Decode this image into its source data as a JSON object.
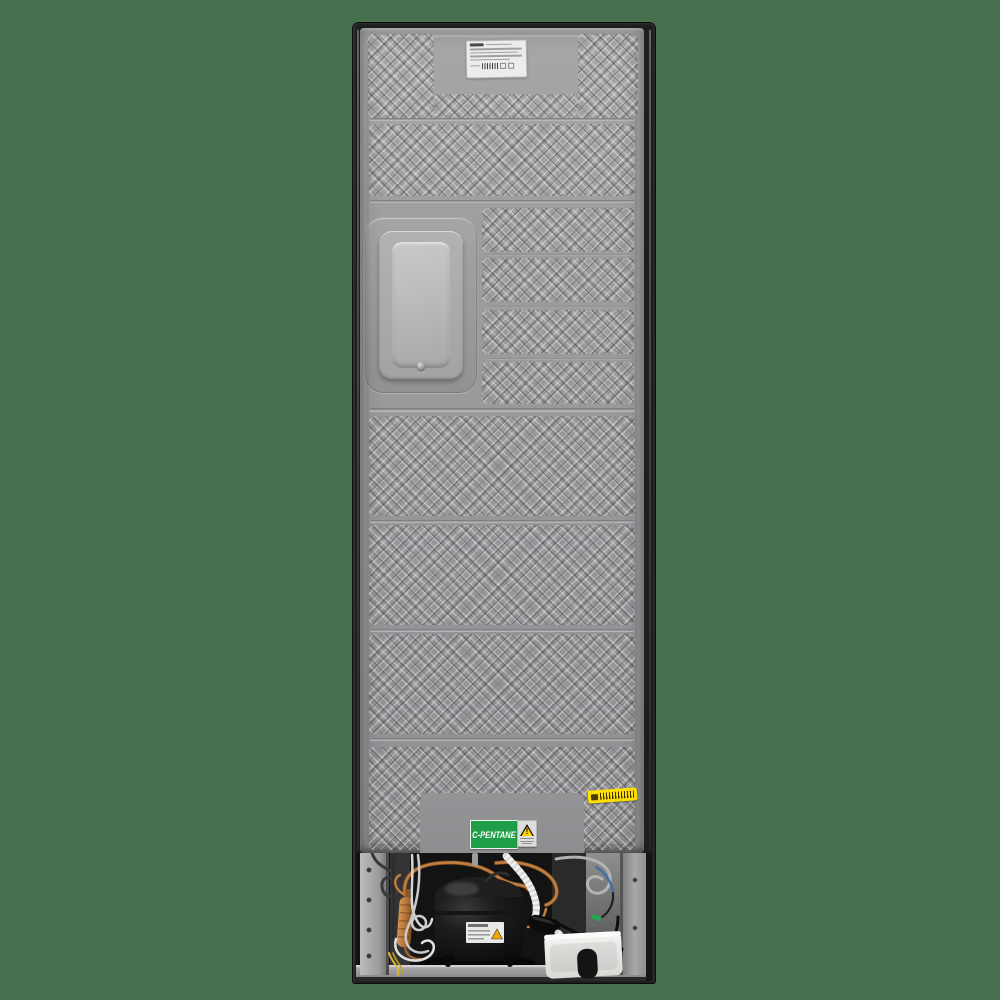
{
  "scene": {
    "subject": "Rear view of a free-standing refrigerator",
    "view": "back panel with embossed diamond texture and open compressor compartment"
  },
  "colors": {
    "background": "#47714e",
    "frame_dark": "#1d1e1e",
    "panel_grey": "#9a9a9c",
    "bracket_grey": "#aaaaaa",
    "compressor_black": "#141414",
    "copper": "#bf7d3f",
    "drain_tray_white": "#ebebe8",
    "refrigerant_green": "#1f9d47",
    "barcode_yellow": "#ffdf00",
    "warning_yellow": "#ffd200"
  },
  "stickers": {
    "refrigerant_label": "C-PENTANE",
    "warning_symbol": "!"
  }
}
